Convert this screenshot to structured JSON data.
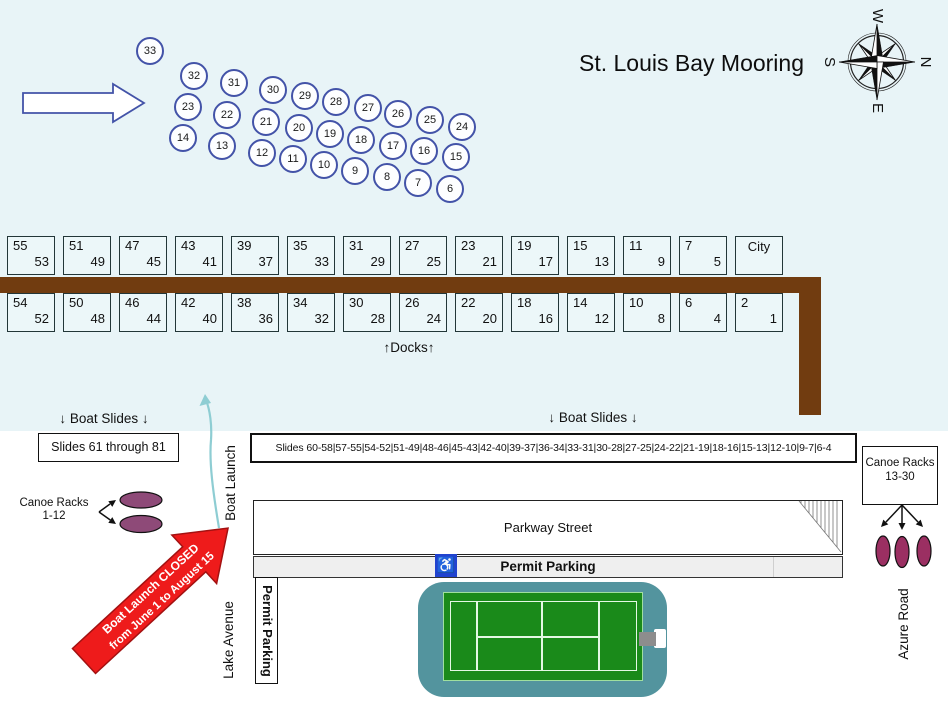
{
  "title": "St. Louis Bay Mooring",
  "compass": {
    "top": "W",
    "right": "N",
    "bottom": "E",
    "left": "S"
  },
  "buoys": {
    "label": "Buoys",
    "items": [
      {
        "n": "33",
        "x": 150,
        "y": 51
      },
      {
        "n": "32",
        "x": 194,
        "y": 76
      },
      {
        "n": "31",
        "x": 234,
        "y": 83
      },
      {
        "n": "30",
        "x": 273,
        "y": 90
      },
      {
        "n": "29",
        "x": 305,
        "y": 96
      },
      {
        "n": "28",
        "x": 336,
        "y": 102
      },
      {
        "n": "27",
        "x": 368,
        "y": 108
      },
      {
        "n": "26",
        "x": 398,
        "y": 114
      },
      {
        "n": "25",
        "x": 430,
        "y": 120
      },
      {
        "n": "24",
        "x": 462,
        "y": 127
      },
      {
        "n": "23",
        "x": 188,
        "y": 107
      },
      {
        "n": "22",
        "x": 227,
        "y": 115
      },
      {
        "n": "21",
        "x": 266,
        "y": 122
      },
      {
        "n": "20",
        "x": 299,
        "y": 128
      },
      {
        "n": "19",
        "x": 330,
        "y": 134
      },
      {
        "n": "18",
        "x": 361,
        "y": 140
      },
      {
        "n": "17",
        "x": 393,
        "y": 146
      },
      {
        "n": "16",
        "x": 424,
        "y": 151
      },
      {
        "n": "15",
        "x": 456,
        "y": 157
      },
      {
        "n": "14",
        "x": 183,
        "y": 138
      },
      {
        "n": "13",
        "x": 222,
        "y": 146
      },
      {
        "n": "12",
        "x": 262,
        "y": 153
      },
      {
        "n": "11",
        "x": 293,
        "y": 159
      },
      {
        "n": "10",
        "x": 324,
        "y": 165
      },
      {
        "n": "9",
        "x": 355,
        "y": 171
      },
      {
        "n": "8",
        "x": 387,
        "y": 177
      },
      {
        "n": "7",
        "x": 418,
        "y": 183
      },
      {
        "n": "6",
        "x": 450,
        "y": 189
      }
    ]
  },
  "docks": {
    "label": "↑Docks↑",
    "top_row": [
      [
        "55",
        "53"
      ],
      [
        "51",
        "49"
      ],
      [
        "47",
        "45"
      ],
      [
        "43",
        "41"
      ],
      [
        "39",
        "37"
      ],
      [
        "35",
        "33"
      ],
      [
        "31",
        "29"
      ],
      [
        "27",
        "25"
      ],
      [
        "23",
        "21"
      ],
      [
        "19",
        "17"
      ],
      [
        "15",
        "13"
      ],
      [
        "11",
        "9"
      ],
      [
        "7",
        "5"
      ],
      [
        "City",
        ""
      ]
    ],
    "bottom_row": [
      [
        "54",
        "52"
      ],
      [
        "50",
        "48"
      ],
      [
        "46",
        "44"
      ],
      [
        "42",
        "40"
      ],
      [
        "38",
        "36"
      ],
      [
        "34",
        "32"
      ],
      [
        "30",
        "28"
      ],
      [
        "26",
        "24"
      ],
      [
        "22",
        "20"
      ],
      [
        "18",
        "16"
      ],
      [
        "14",
        "12"
      ],
      [
        "10",
        "8"
      ],
      [
        "6",
        "4"
      ],
      [
        "2",
        "1"
      ]
    ]
  },
  "slides": {
    "left_label": "↓ Boat Slides ↓",
    "right_label": "↓ Boat Slides ↓",
    "left_box": "Slides 61 through 81",
    "long_box": "Slides 60-58|57-55|54-52|51-49|48-46|45-43|42-40|39-37|36-34|33-31|30-28|27-25|24-22|21-19|18-16|15-13|12-10|9-7|6-4"
  },
  "canoe_racks": {
    "left_line1": "Canoe Racks",
    "left_line2": "1-12",
    "right_line1": "Canoe Racks",
    "right_line2": "13-30"
  },
  "roads": {
    "parkway": "Parkway Street",
    "lake": "Lake Avenue",
    "azure": "Azure Road"
  },
  "parking": {
    "strip_label": "Permit Parking",
    "vertical_label": "Permit Parking",
    "handicap_symbol": "♿"
  },
  "boat_launch": {
    "label": "Boat Launch",
    "closed_line1": "Boat Launch CLOSED",
    "closed_line2": "from June 1 to August 15"
  },
  "colors": {
    "water": "#e8f4f7",
    "buoy_blue": "#4353a8",
    "dock_brown": "#713c10",
    "closed_red": "#ee1b1b",
    "closed_red_border": "#a31111",
    "launch_teal": "#8ecdd3",
    "court_teal": "#53949e",
    "court_green": "#1a8a1a",
    "court_line": "#e4f8e4",
    "canoe_plum": "#8e4a78",
    "canoe_crimson": "#9b2f62",
    "handicap_blue": "#2143cf"
  }
}
